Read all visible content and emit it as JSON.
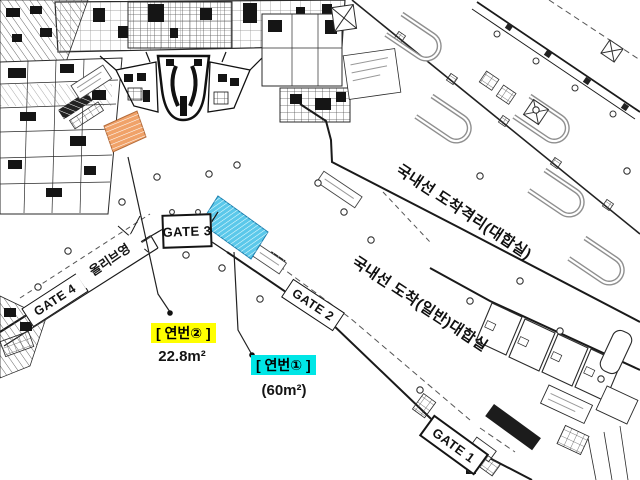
{
  "plan": {
    "gates": {
      "gate1": "GATE 1",
      "gate2": "GATE 2",
      "gate3": "GATE 3",
      "gate4": "GATE 4"
    },
    "rooms": {
      "shop_olive": "올리브영",
      "hall_quarantine": "국내선 도착격리(대합실)",
      "hall_general": "국내선 도착(일반)대합실"
    },
    "annotations": {
      "zone2": {
        "label": "[ 연번② ]",
        "area": "22.8m²"
      },
      "zone1": {
        "label": "[ 연번① ]",
        "area": "(60m²)"
      }
    }
  },
  "colors": {
    "zone1_label_bg": "#00e6e6",
    "zone2_label_bg": "#ffff00",
    "zone1_fill": "#5bc8ea",
    "zone1_stroke": "#1c7fae",
    "zone2_fill": "#f0a269",
    "zone2_stroke": "#b36b3a",
    "line": "#1a1a1a"
  }
}
